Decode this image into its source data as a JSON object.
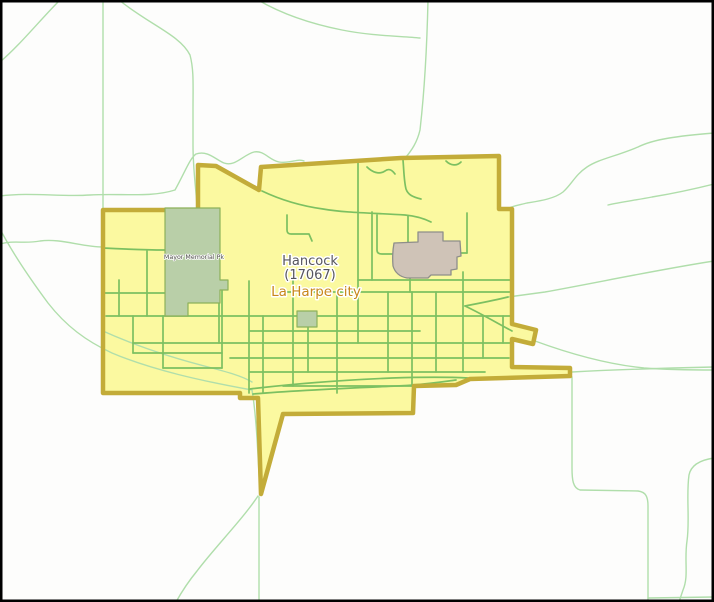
{
  "map": {
    "labels": {
      "county_name": "Hancock",
      "county_code": "(17067)",
      "place_name": "La Harpe city",
      "park_name": "Mayor Memorial Pk"
    }
  },
  "colors": {
    "frame": "#000000",
    "map_bg": "#fdfdfc",
    "city_fill": "#fbf9a0",
    "city_border": "#c3ac39",
    "street": "#7cc061",
    "rural_road": "#b0deab",
    "park_fill": "#b9cfa8",
    "park_stroke": "#8db15a",
    "landmark_fill": "#cfc3b7",
    "landmark_stroke": "#8e8e8a",
    "county_label": "#56555e",
    "place_label": "#c8871b",
    "park_label": "#4b4b46"
  }
}
